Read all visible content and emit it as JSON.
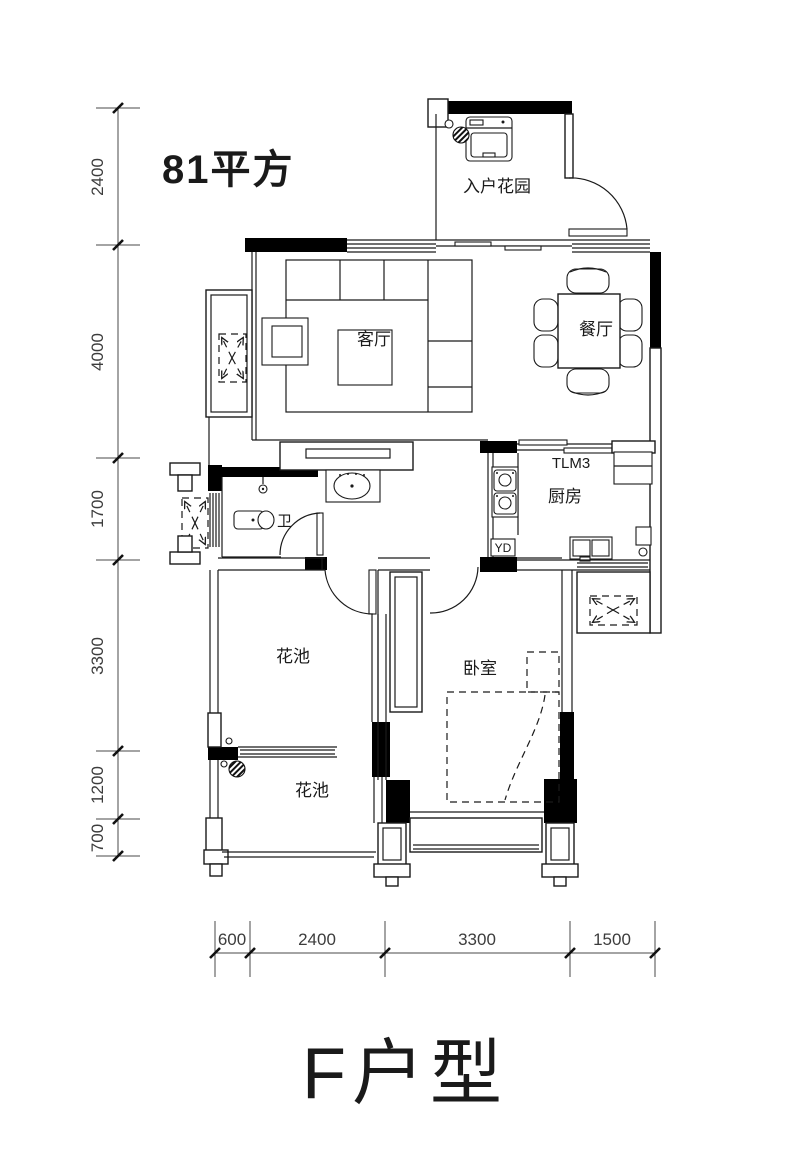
{
  "plan": {
    "area_label": "81平方",
    "title": "F户型",
    "rooms": [
      {
        "id": "entry-garden",
        "label": "入户花园"
      },
      {
        "id": "living-room",
        "label": "客厅"
      },
      {
        "id": "dining-room",
        "label": "餐厅"
      },
      {
        "id": "kitchen",
        "label": "厨房"
      },
      {
        "id": "bathroom",
        "label": "卫"
      },
      {
        "id": "bedroom",
        "label": "卧室"
      },
      {
        "id": "flower-bed-upper",
        "label": "花池"
      },
      {
        "id": "flower-bed-lower",
        "label": "花池"
      }
    ],
    "annotations": [
      {
        "id": "sliding-door-tag",
        "label": "TLM3"
      },
      {
        "id": "floor-drain-tag",
        "label": "YD"
      }
    ],
    "dimensions": {
      "left": [
        "2400",
        "4000",
        "1700",
        "3300",
        "1200",
        "700"
      ],
      "bottom": [
        "600",
        "2400",
        "3300",
        "1500"
      ]
    },
    "colors": {
      "area_label": "#e73b4e",
      "walls": "#000000",
      "lines": "#1a1a1a",
      "background": "#ffffff"
    }
  }
}
